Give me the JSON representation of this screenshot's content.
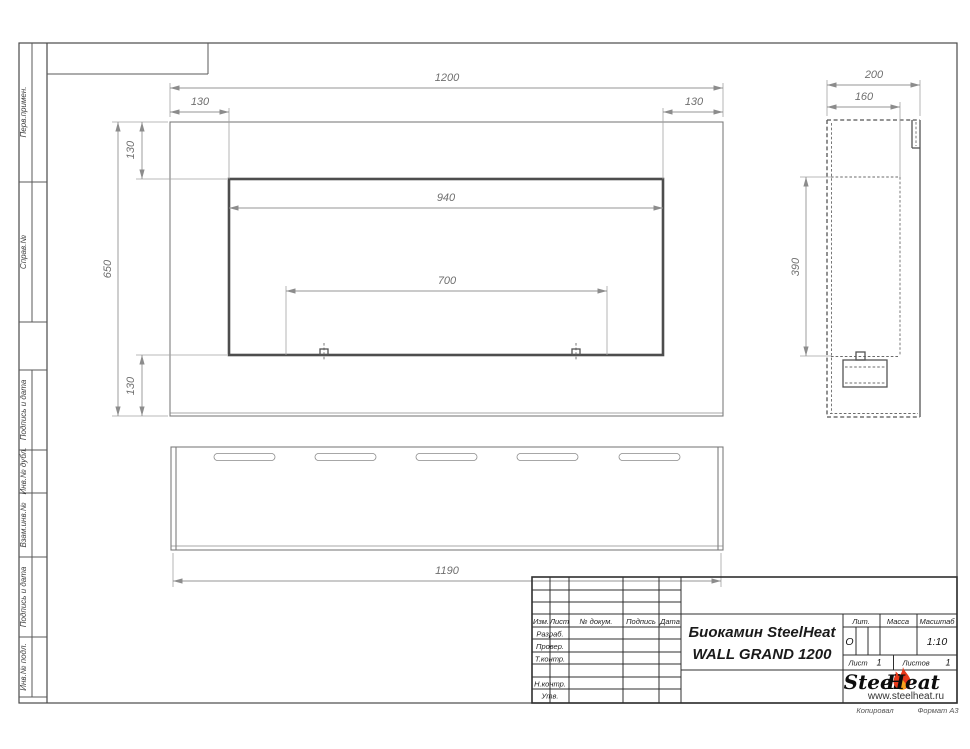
{
  "margin_columns": {
    "perv_primen": "Перв.примен.",
    "sprav_no": "Справ.№",
    "podpis_i_data_upper": "Подпись и дата",
    "inv_no_dubl": "Инв.№ дубл.",
    "vzam_inv_no": "Взам.инв.№",
    "podpis_i_data_lower": "Подпись и дата",
    "inv_no_podl": "Инв.№ подл."
  },
  "front_view": {
    "overall_width": "1200",
    "left_inset": "130",
    "right_inset": "130",
    "opening_width": "940",
    "burner_span": "700",
    "overall_height": "650",
    "top_inset": "130",
    "bottom_inset": "130"
  },
  "side_view": {
    "depth": "200",
    "inner_depth": "160",
    "opening_height": "390"
  },
  "bottom_view": {
    "length": "1190"
  },
  "title_block": {
    "header_izm": "Изм.",
    "header_list": "Лист",
    "header_dokum": "№ докум.",
    "header_podpis": "Подпись",
    "header_data": "Дата",
    "row_razrab": "Разраб.",
    "row_prover": "Провер.",
    "row_tkontr": "Т.контр.",
    "row_nkontr": "Н.контр.",
    "row_utv": "Утв.",
    "title_line1": "Биокамин SteelHeat",
    "title_line2": "WALL GRAND 1200",
    "lit_label": "Лит.",
    "lit_value": "О",
    "massa_label": "Масса",
    "masshtab_label": "Масштаб",
    "masshtab_value": "1:10",
    "list_label": "Лист",
    "list_value": "1",
    "listov_label": "Листов",
    "listov_value": "1"
  },
  "logo": {
    "steel": "Steel",
    "heat": "Heat",
    "url": "www.steelheat.ru"
  },
  "footer": {
    "kopiroval": "Копировал",
    "format": "Формат А3"
  },
  "colors": {
    "flame_outer": "#e8391b",
    "flame_inner": "#f6a21c",
    "line_dark": "#2f2f2f",
    "line_mid": "#7d7d7d",
    "line_dim": "#949494"
  }
}
